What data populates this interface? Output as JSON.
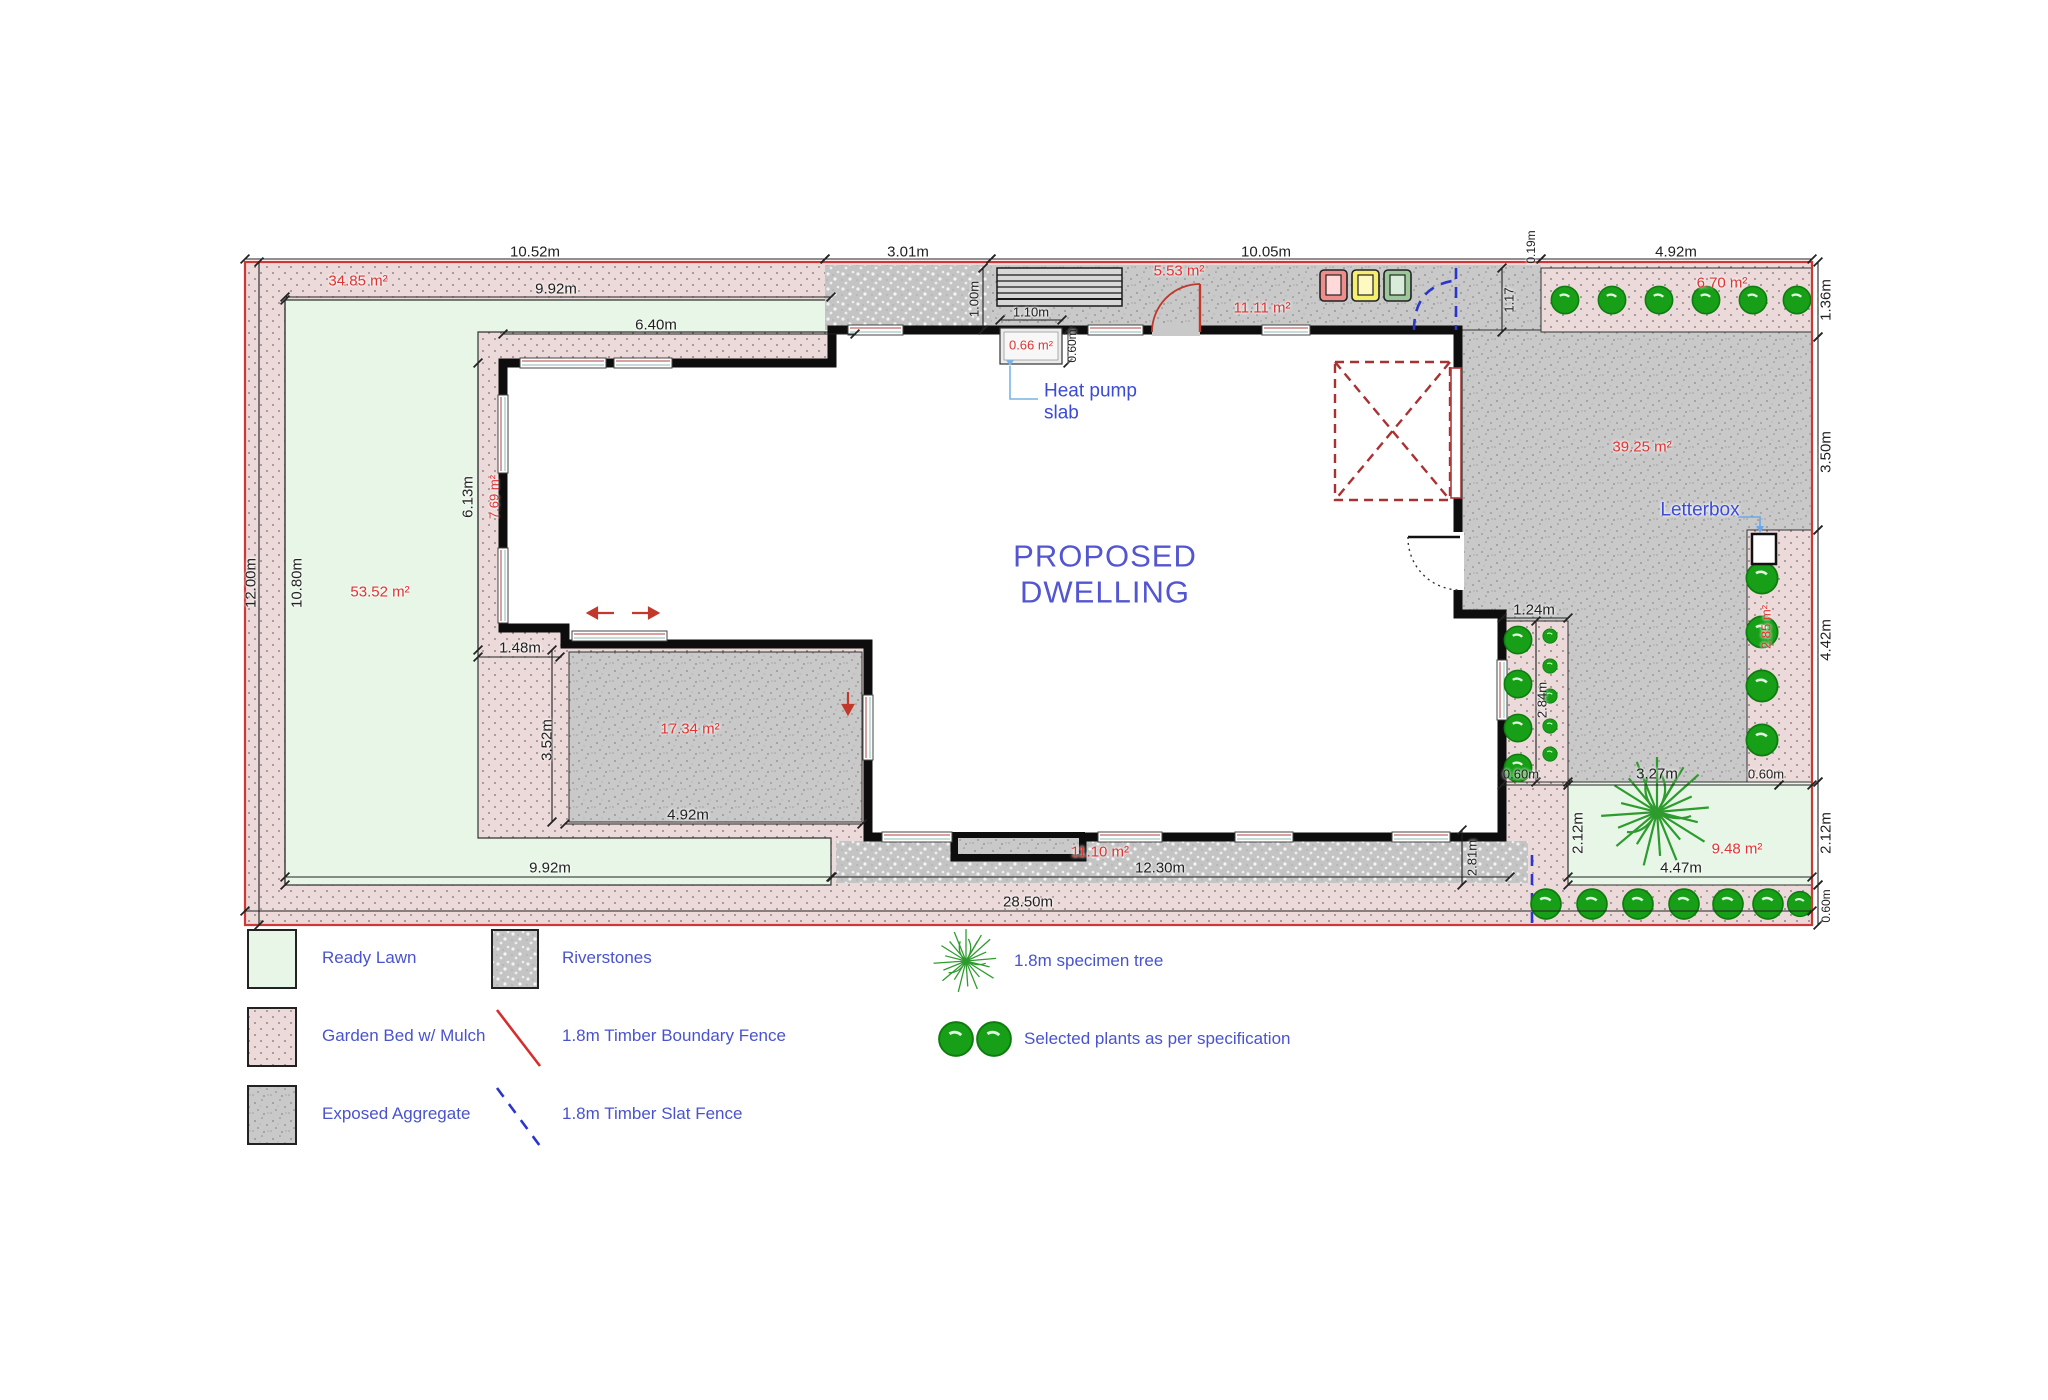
{
  "title": {
    "line1": "PROPOSED",
    "line2": "DWELLING"
  },
  "colors": {
    "boundary_fence_red": "#cf3636",
    "slat_fence_blue": "#2b35cc",
    "annotation_blue": "#3b4bd8",
    "area_label_red": "#e03434",
    "title_blue": "#5355d1",
    "lawn_green": "#e7f6e7",
    "garden_bed_pink": "#ecd9d9",
    "aggregate_gray": "#c9c9c9",
    "riverstone_gray": "#c6c6c6",
    "plant_green": "#17a017"
  },
  "dims": {
    "top1": "10.52m",
    "top2": "3.01m",
    "top3": "10.05m",
    "top4": "4.92m",
    "top_gap": "0.19m",
    "left_site": "12.00m",
    "left_lawn": "10.80m",
    "right1": "1.36m",
    "right2": "3.50m",
    "right3": "4.42m",
    "right4": "2.12m",
    "right5": "0.60m",
    "bottom_site": "28.50m",
    "lawn_top": "9.92m",
    "wing_top": "6.40m",
    "path_w": "1.00m",
    "niche_w": "1.10m",
    "niche_d": "0.60m",
    "wing_left": "6.13m",
    "bed_offset": "1.48m",
    "court_h": "3.52m",
    "court_w": "4.92m",
    "lawn_bottom": "9.92m",
    "river": "12.30m",
    "river_end": "2.81m",
    "bed_gap": "1.17",
    "strip_w": "1.24m",
    "strip_h": "2.84m",
    "strip_end": "0.60m",
    "lawn2_top": "3.27m",
    "lawn2_top_r": "0.60m",
    "lawn2_left": "2.12m",
    "lawn2_bottom": "4.47m"
  },
  "areas": {
    "bed_top": "34.85 m²",
    "path": "5.53 m²",
    "bed_plants": "6.70 m²",
    "entry": "11.11 m²",
    "niche": "0.66 m²",
    "driveway": "39.25 m²",
    "lawn": "53.52 m²",
    "bed_left": "7.69 m²",
    "courtyard": "17.34 m²",
    "river": "11.10 m²",
    "lawn2": "9.48 m²",
    "strip_lb": "2.85 m²"
  },
  "notes": {
    "heat1": "Heat pump",
    "heat2": "slab",
    "letterbox": "Letterbox"
  },
  "legend": {
    "items": [
      {
        "id": "ready-lawn",
        "label": "Ready Lawn"
      },
      {
        "id": "garden-bed",
        "label": "Garden Bed w/ Mulch"
      },
      {
        "id": "exposed-aggregate",
        "label": "Exposed Aggregate"
      },
      {
        "id": "riverstones",
        "label": "Riverstones"
      },
      {
        "id": "boundary-fence",
        "label": "1.8m Timber Boundary Fence"
      },
      {
        "id": "slat-fence",
        "label": "1.8m Timber Slat Fence"
      },
      {
        "id": "specimen-tree",
        "label": "1.8m specimen tree"
      },
      {
        "id": "selected-plants",
        "label": "Selected plants as per specification"
      }
    ]
  }
}
